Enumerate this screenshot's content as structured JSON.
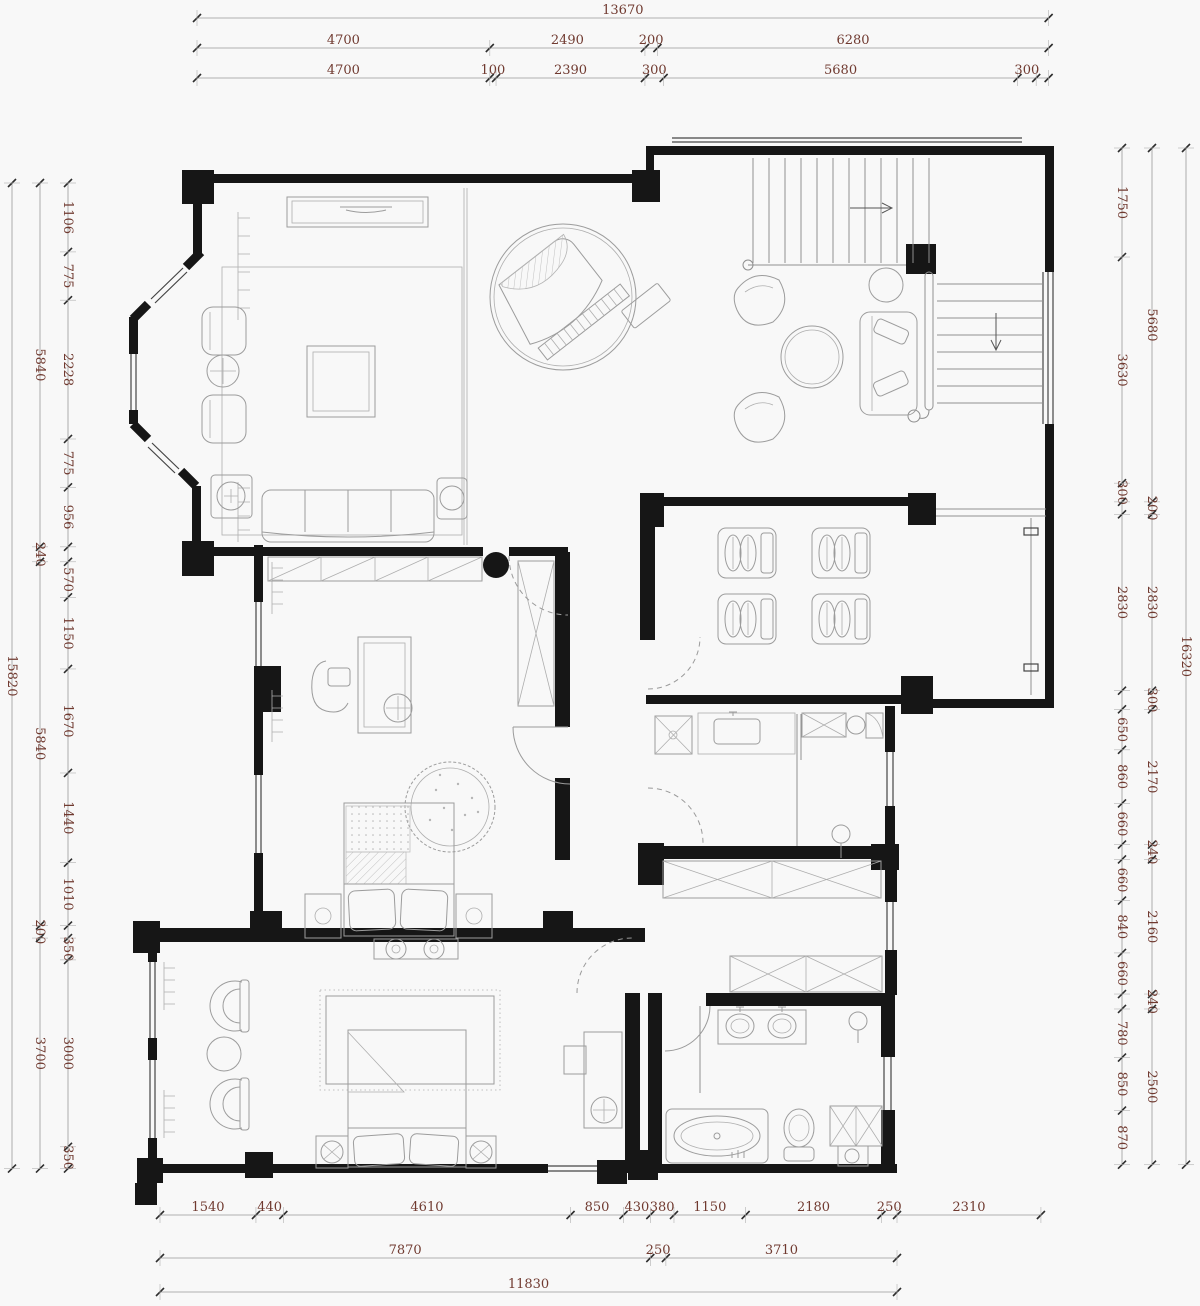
{
  "colors": {
    "dimension_text": "#703a30",
    "wall": "#161616",
    "furniture_line": "#9c9c9c",
    "window_line": "#444444",
    "background": "#f8f8f8"
  },
  "dim_chains": {
    "top_outer": [
      [
        13670
      ]
    ],
    "top_middle": [
      [
        4700
      ],
      [
        2490
      ],
      [
        200
      ],
      [
        6280
      ]
    ],
    "top_inner": [
      [
        4700
      ],
      [
        100
      ],
      [
        2390
      ],
      [
        300
      ],
      [
        5680
      ],
      [
        300
      ],
      [
        200,
        ""
      ]
    ],
    "bottom_inner": [
      [
        1540
      ],
      [
        440
      ],
      [
        4610
      ],
      [
        850
      ],
      [
        430
      ],
      [
        380
      ],
      [
        1150
      ],
      [
        2180
      ],
      [
        250
      ],
      [
        2310
      ]
    ],
    "bottom_middle": [
      [
        7870
      ],
      [
        250
      ],
      [
        3710
      ]
    ],
    "bottom_outer": [
      [
        11830
      ]
    ],
    "left_inner": [
      [
        1106
      ],
      [
        775
      ],
      [
        2228
      ],
      [
        775
      ],
      [
        956
      ],
      [
        240,
        ""
      ],
      [
        570
      ],
      [
        1150
      ],
      [
        1670
      ],
      [
        1440
      ],
      [
        1010
      ],
      [
        200,
        ""
      ],
      [
        350
      ],
      [
        3000
      ],
      [
        350
      ]
    ],
    "left_middle": [
      [
        5840
      ],
      [
        240
      ],
      [
        5840
      ],
      [
        200
      ],
      [
        3700
      ]
    ],
    "left_outer": [
      [
        15820
      ]
    ],
    "right_inner": [
      [
        1750
      ],
      [
        3630
      ],
      [
        300
      ],
      [
        200,
        ""
      ],
      [
        2830
      ],
      [
        300,
        ""
      ],
      [
        650
      ],
      [
        860
      ],
      [
        660
      ],
      [
        240,
        ""
      ],
      [
        660
      ],
      [
        840
      ],
      [
        660
      ],
      [
        240,
        ""
      ],
      [
        780
      ],
      [
        850
      ],
      [
        870
      ]
    ],
    "right_middle": [
      [
        5680
      ],
      [
        200
      ],
      [
        2830
      ],
      [
        300
      ],
      [
        2170
      ],
      [
        240
      ],
      [
        2160
      ],
      [
        240
      ],
      [
        2500
      ]
    ],
    "right_outer": [
      [
        16320
      ]
    ]
  }
}
